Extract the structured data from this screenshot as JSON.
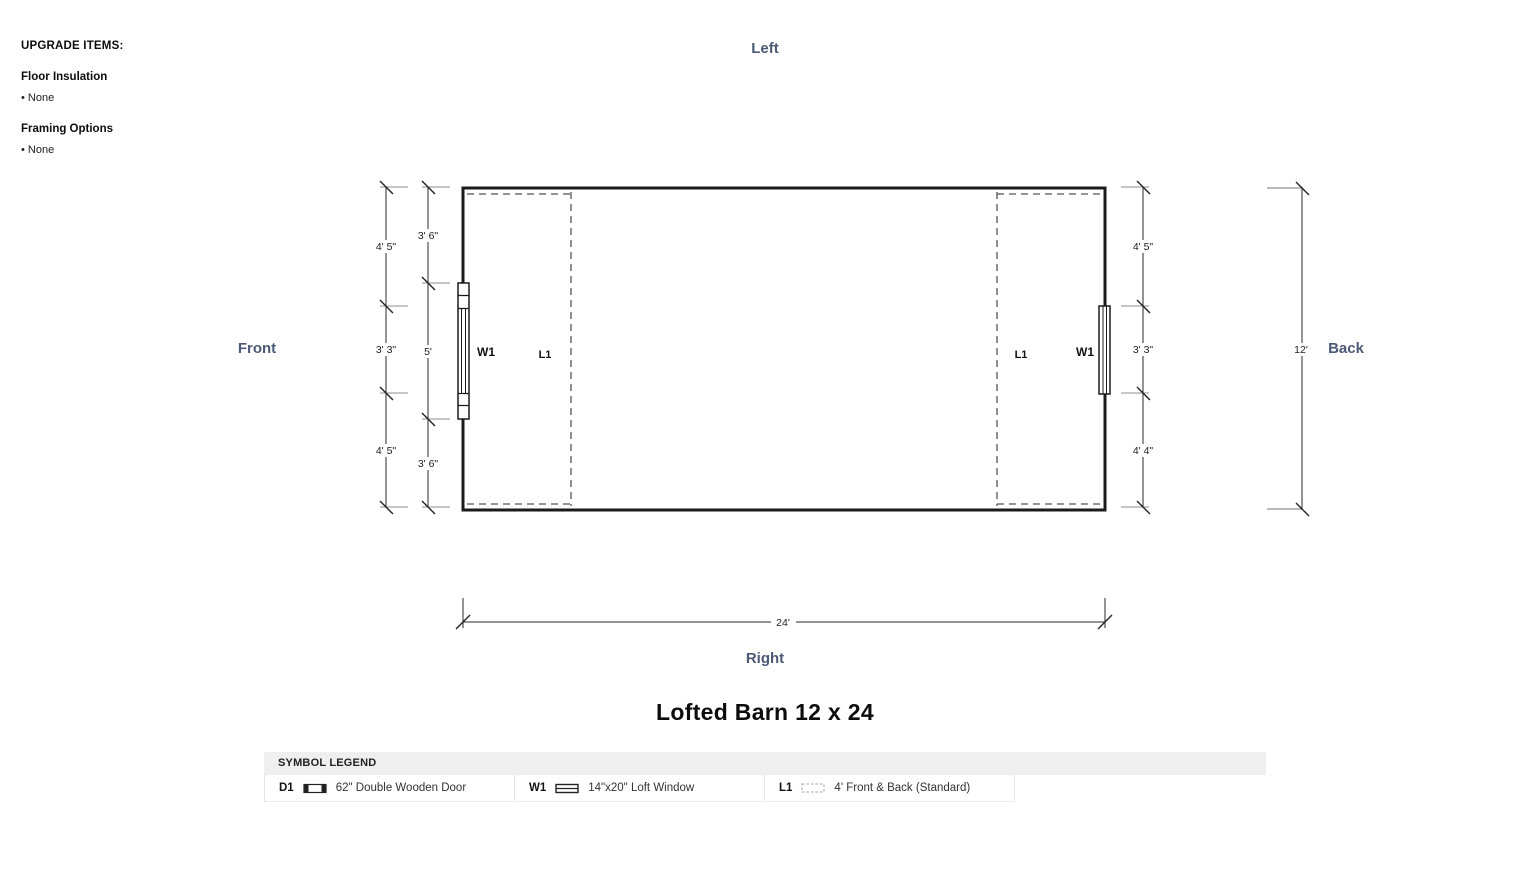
{
  "upgrade_panel": {
    "title": "UPGRADE ITEMS:",
    "items": [
      {
        "heading": "Floor Insulation",
        "value": "• None"
      },
      {
        "heading": "Framing Options",
        "value": "• None"
      }
    ]
  },
  "orientation": {
    "top": "Left",
    "left": "Front",
    "right": "Back",
    "bottom": "Right"
  },
  "plan": {
    "title": "Lofted Barn 12 x 24",
    "labels": {
      "front_window": "W1",
      "back_window": "W1",
      "front_loft": "L1",
      "back_loft": "L1"
    },
    "dims": {
      "left_outer": [
        "4' 5\"",
        "3' 3\"",
        "4' 5\""
      ],
      "left_inner": [
        "3' 6\"",
        "5'",
        "3' 6\""
      ],
      "right": [
        "4' 5\"",
        "3' 3\"",
        "4' 4\""
      ],
      "total_width": "24'",
      "total_depth": "12'"
    }
  },
  "legend": {
    "header": "SYMBOL LEGEND",
    "entries": [
      {
        "code": "D1",
        "icon": "double-door-icon",
        "label": "62\" Double Wooden Door"
      },
      {
        "code": "W1",
        "icon": "loft-window-icon",
        "label": "14\"x20\" Loft Window"
      },
      {
        "code": "L1",
        "icon": "loft-area-dashed-icon",
        "label": "4' Front & Back (Standard)"
      }
    ]
  },
  "colors": {
    "orientation_label": "#4c5a76",
    "drawing_line": "#1b1b1b",
    "dashed_line": "#555555",
    "extension_line": "#8f8f8f",
    "legend_header_bg": "#efefef"
  }
}
